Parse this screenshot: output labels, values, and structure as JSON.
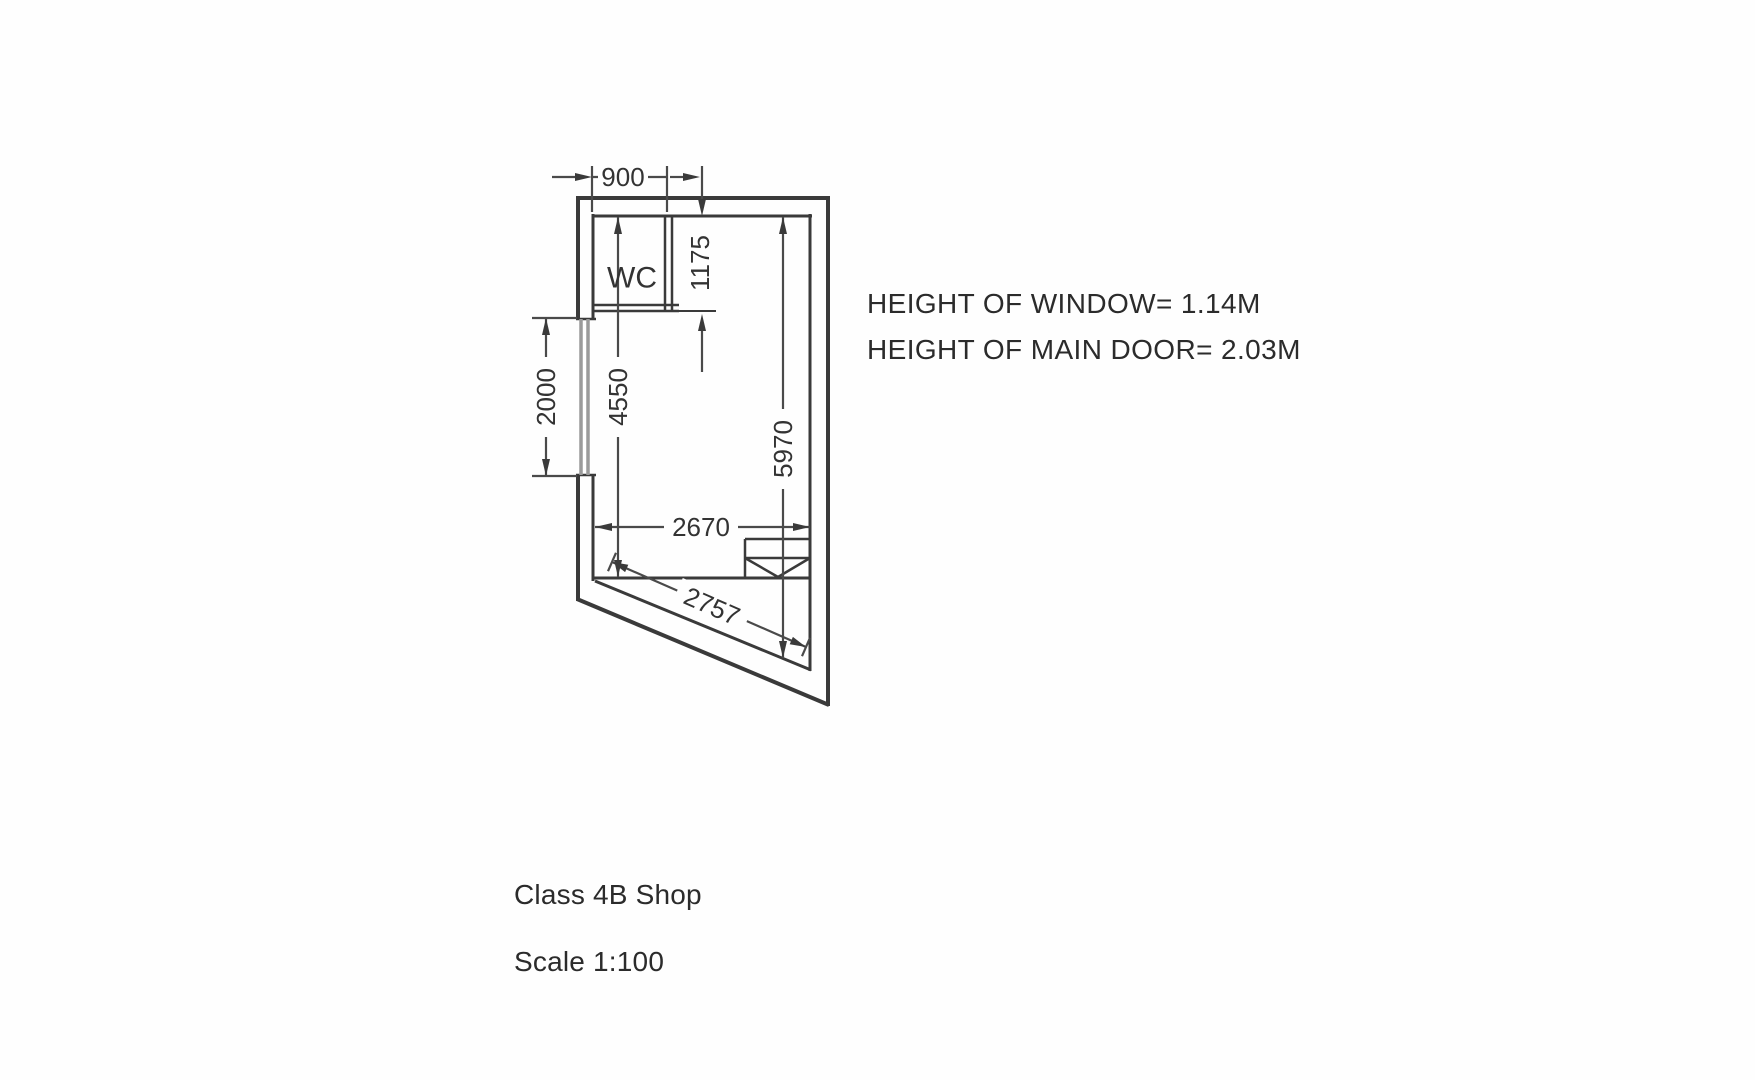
{
  "page": {
    "background": "#fefefe",
    "line_color": "#3a3a3a",
    "text_color": "#2b2b2b"
  },
  "plan": {
    "room_label": "WC",
    "dims": {
      "top_width": "900",
      "wc_depth": "1175",
      "window_length": "2000",
      "interior_left_depth": "4550",
      "interior_right_depth": "5970",
      "interior_width": "2670",
      "splay_wall_length": "2757"
    }
  },
  "notes": {
    "window_height": "HEIGHT OF WINDOW= 1.14M",
    "door_height": "HEIGHT OF MAIN DOOR= 2.03M"
  },
  "captions": {
    "class_label": "Class 4B Shop",
    "scale_label": "Scale 1:100"
  }
}
